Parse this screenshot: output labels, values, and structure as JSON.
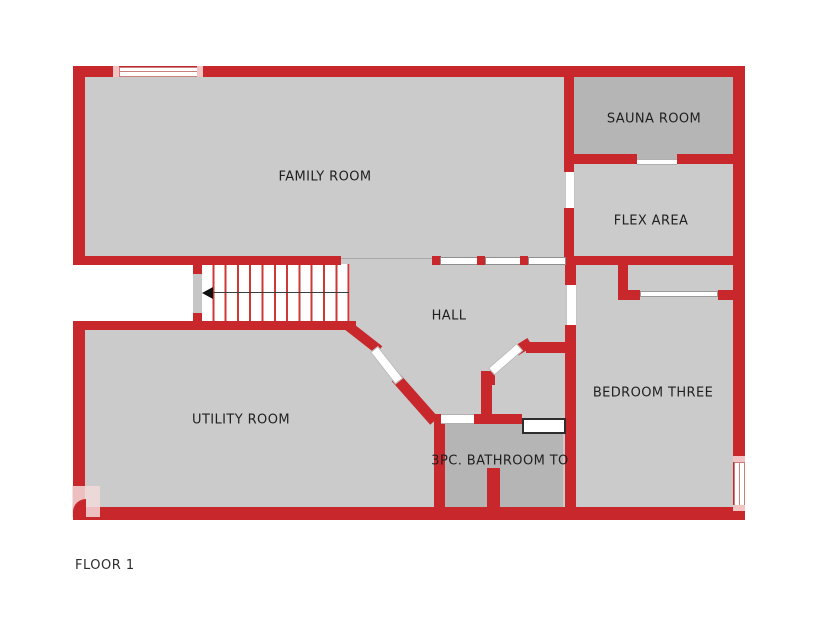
{
  "meta": {
    "floor_label": "FLOOR 1"
  },
  "rooms": {
    "family": "FAMILY ROOM",
    "sauna": "SAUNA ROOM",
    "flex": "FLEX AREA",
    "hall": "HALL",
    "utility": "UTILITY ROOM",
    "bedroom": "BEDROOM THREE",
    "bathroom": "3PC. BATHROOM TO"
  },
  "colors": {
    "wall": "#c8272b",
    "room_light": "#cbcbcb",
    "room_dark": "#b5b5b5",
    "accent_pink": "#f2c4c4",
    "text": "#1f1f1f"
  }
}
